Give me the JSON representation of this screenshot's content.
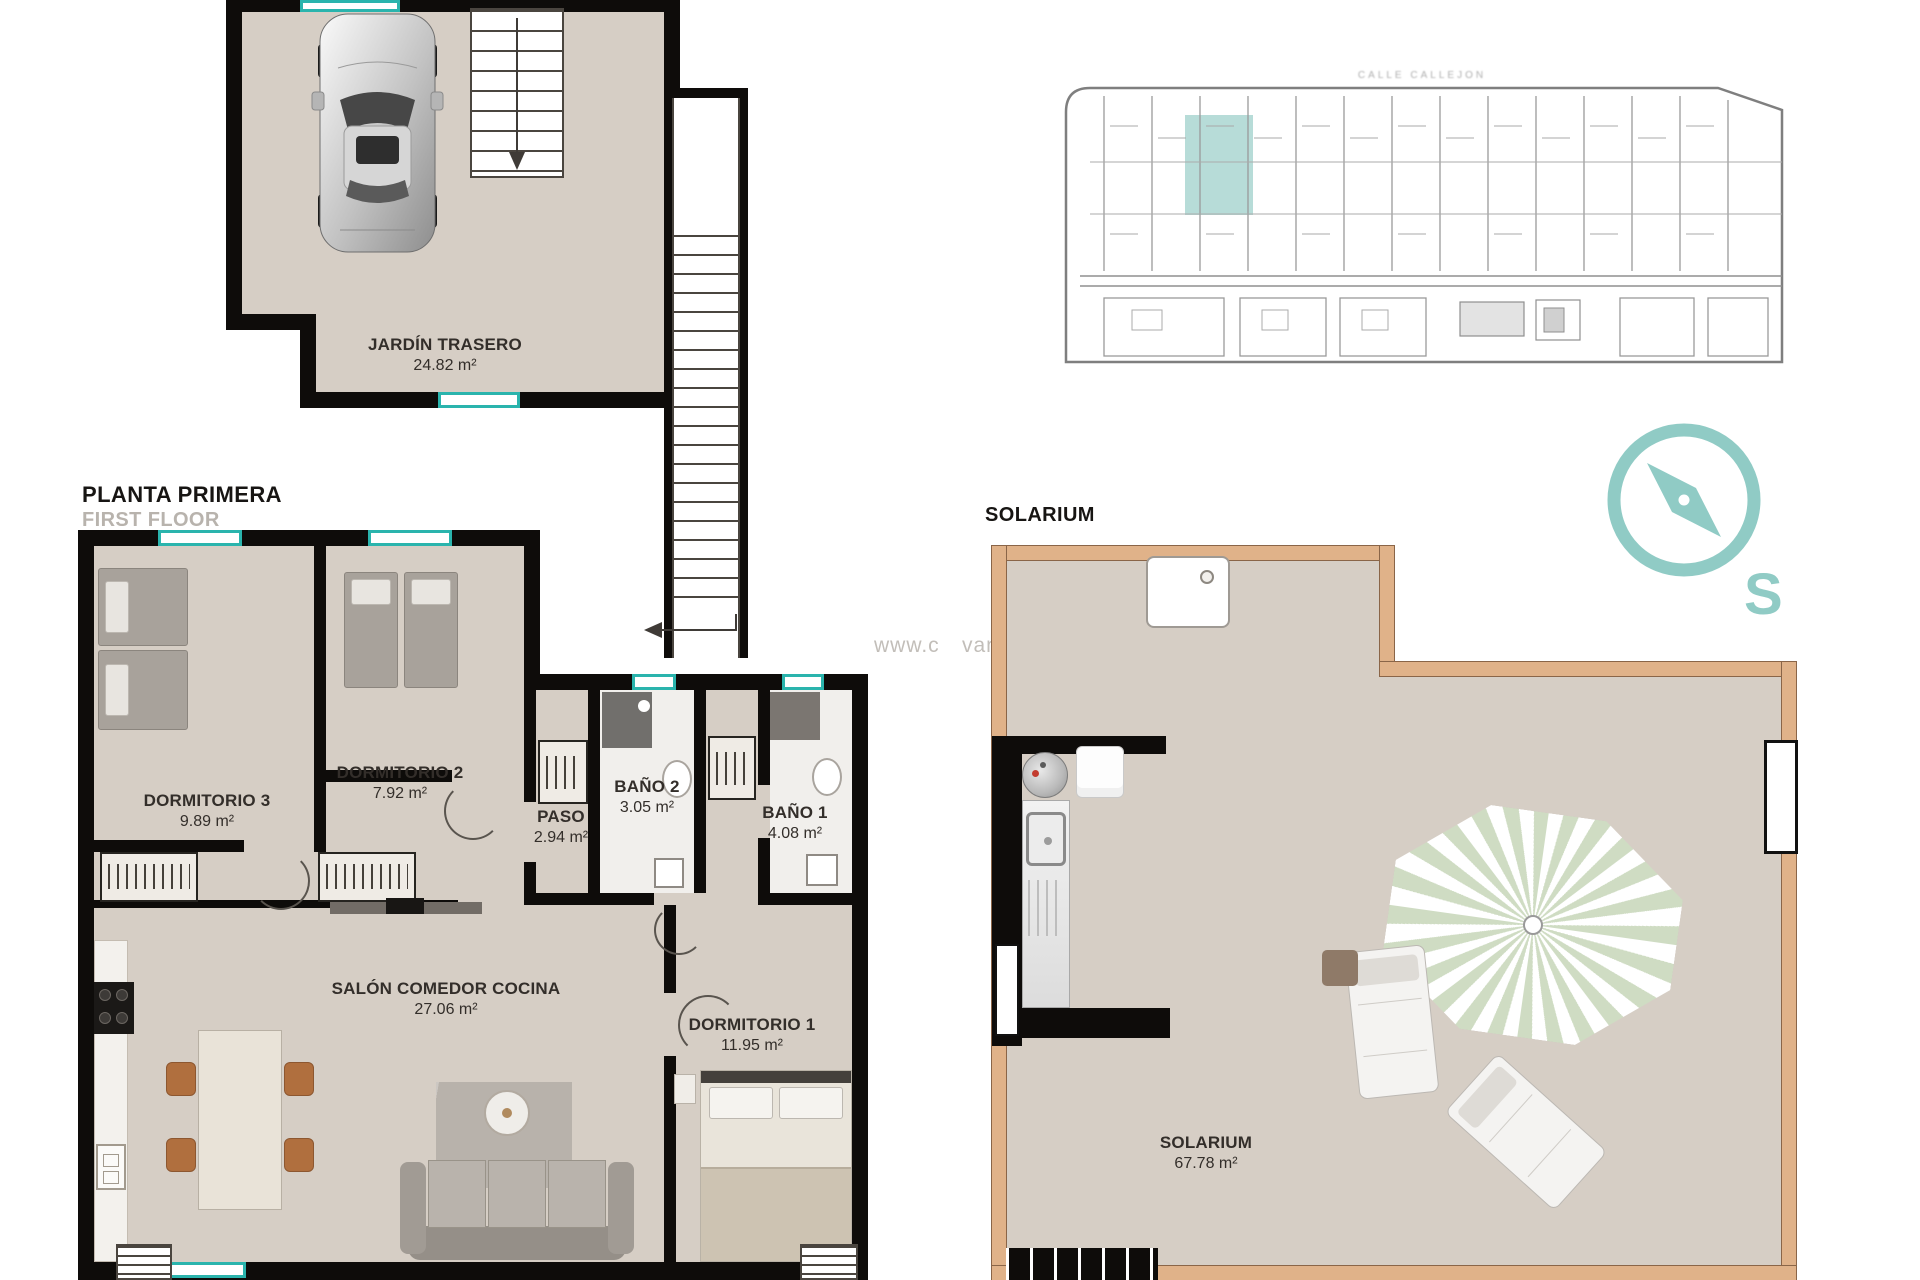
{
  "titles": {
    "floor_title": "PLANTA PRIMERA",
    "floor_subtitle": "FIRST FLOOR",
    "solarium_header": "SOLARIUM",
    "street_label": "CALLE CALLEJON",
    "compass_letter": "S",
    "watermark_prefix": "www.c",
    "watermark_suffix": "vanza .com"
  },
  "rooms": [
    {
      "name": "JARDÍN TRASERO",
      "area": "24.82 m²"
    },
    {
      "name": "DORMITORIO 3",
      "area": "9.89 m²"
    },
    {
      "name": "DORMITORIO 2",
      "area": "7.92 m²"
    },
    {
      "name": "PASO",
      "area": "2.94 m²"
    },
    {
      "name": "BAÑO 2",
      "area": "3.05 m²"
    },
    {
      "name": "BAÑO 1",
      "area": "4.08 m²"
    },
    {
      "name": "SALÓN COMEDOR COCINA",
      "area": "27.06 m²"
    },
    {
      "name": "DORMITORIO 1",
      "area": "11.95 m²"
    },
    {
      "name": "SOLARIUM",
      "area": "67.78 m²"
    }
  ],
  "colors": {
    "floor": "#d6cec5",
    "wall": "#0e0c0a",
    "window_teal": "#2ab4ad",
    "site_highlight": "#b7dcd8",
    "compass_teal": "#90cbc5",
    "solarium_wall": "#e0b289",
    "umbrella_green": "#cfdcc3"
  }
}
